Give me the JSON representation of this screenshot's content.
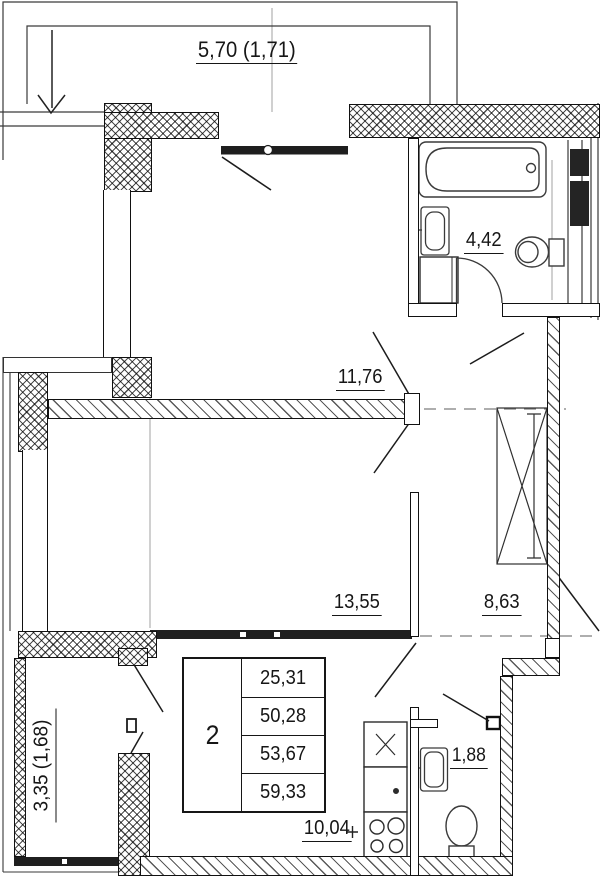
{
  "title": "2-room apartment floor plan",
  "rooms": {
    "balcony_top": {
      "label": "5,70 (1,71)"
    },
    "living_room": {
      "label": "11,76"
    },
    "bathroom": {
      "label": "4,42"
    },
    "bedroom": {
      "label": "13,55"
    },
    "hallway": {
      "label": "8,63"
    },
    "balcony_left": {
      "label": "3,35 (1,68)"
    },
    "wc": {
      "label": "1,88"
    },
    "kitchen": {
      "label": "10,04"
    }
  },
  "summary_table": {
    "rooms_count": "2",
    "rows": [
      "25,31",
      "50,28",
      "53,67",
      "59,33"
    ]
  },
  "colors": {
    "line": "#161616",
    "guide": "#a8a8a8"
  }
}
